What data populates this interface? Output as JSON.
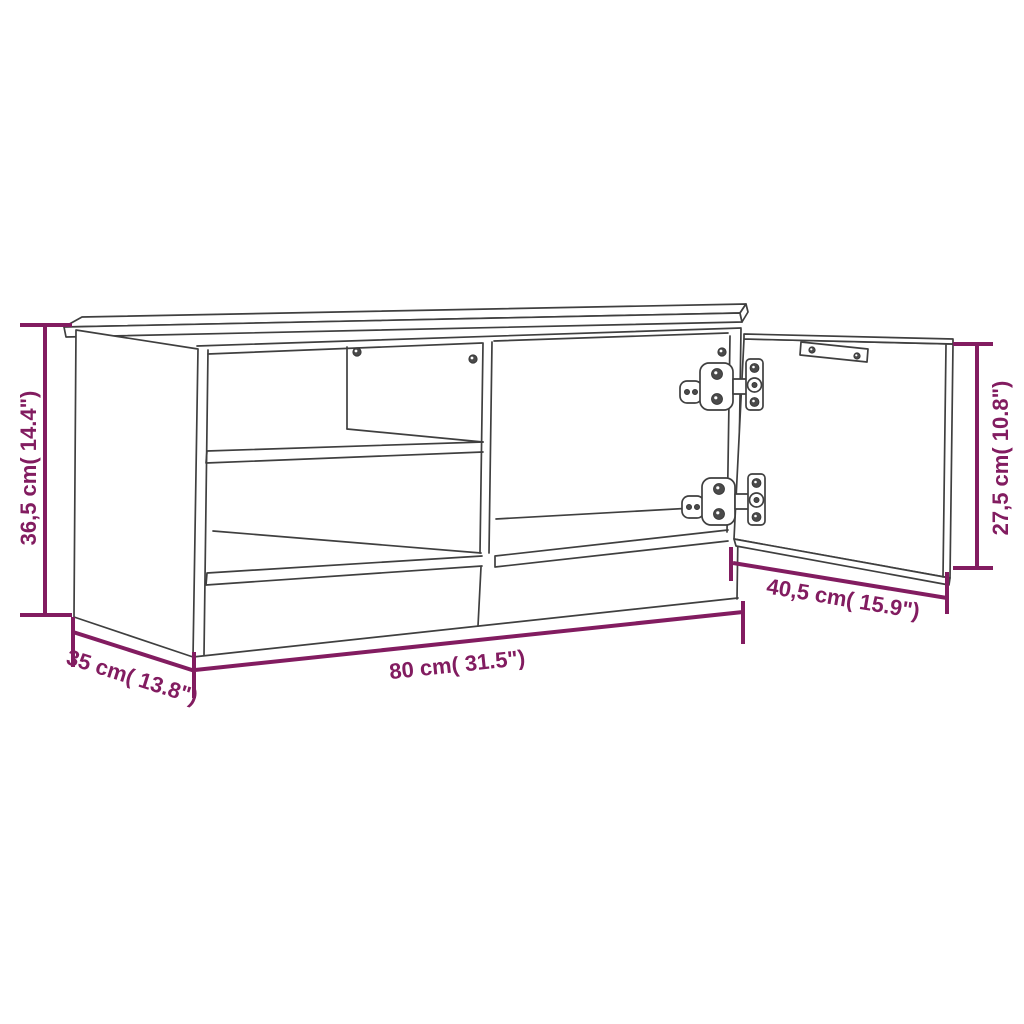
{
  "colors": {
    "accent": "#821C60",
    "line": "#3F3F3F",
    "background": "#FFFFFF"
  },
  "dimensions": {
    "height": {
      "label": "36,5 cm( 14.4\")",
      "metric": "36,5 cm",
      "imperial": "14.4\""
    },
    "depth": {
      "label": "35 cm( 13.8\")",
      "metric": "35 cm",
      "imperial": "13.8\""
    },
    "width": {
      "label": "80 cm( 31.5\")",
      "metric": "80 cm",
      "imperial": "31.5\""
    },
    "door_width": {
      "label": "40,5 cm( 15.9\")",
      "metric": "40,5 cm",
      "imperial": "15.9\""
    },
    "door_height": {
      "label": "27,5 cm( 10.8\")",
      "metric": "27,5 cm",
      "imperial": "10.8\""
    }
  }
}
